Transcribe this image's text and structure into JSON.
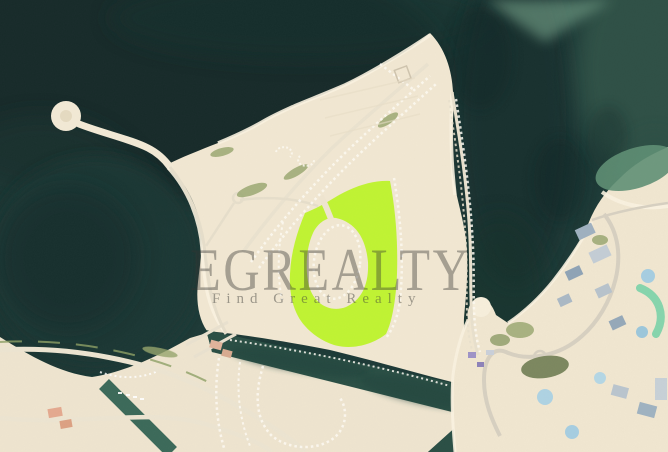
{
  "watermark": {
    "brand": "EGREALTY",
    "tagline": "Find Great Realty"
  },
  "map": {
    "type": "satellite-aerial-view",
    "colors": {
      "water": "#1e3a37",
      "deep_water": "#122625",
      "shallow_water": "#7fae93",
      "sand": "#f1e7d2",
      "sand_sw": "#eee4cf",
      "sand_right": "#f0e6d0",
      "beach": "#f9f2e0",
      "canal": "#2b4f45",
      "small_canal": "#3c6a5a",
      "highlight_plot": "#bdf32a",
      "road": "#eae2cf",
      "landscaping": "#96a56d"
    }
  }
}
